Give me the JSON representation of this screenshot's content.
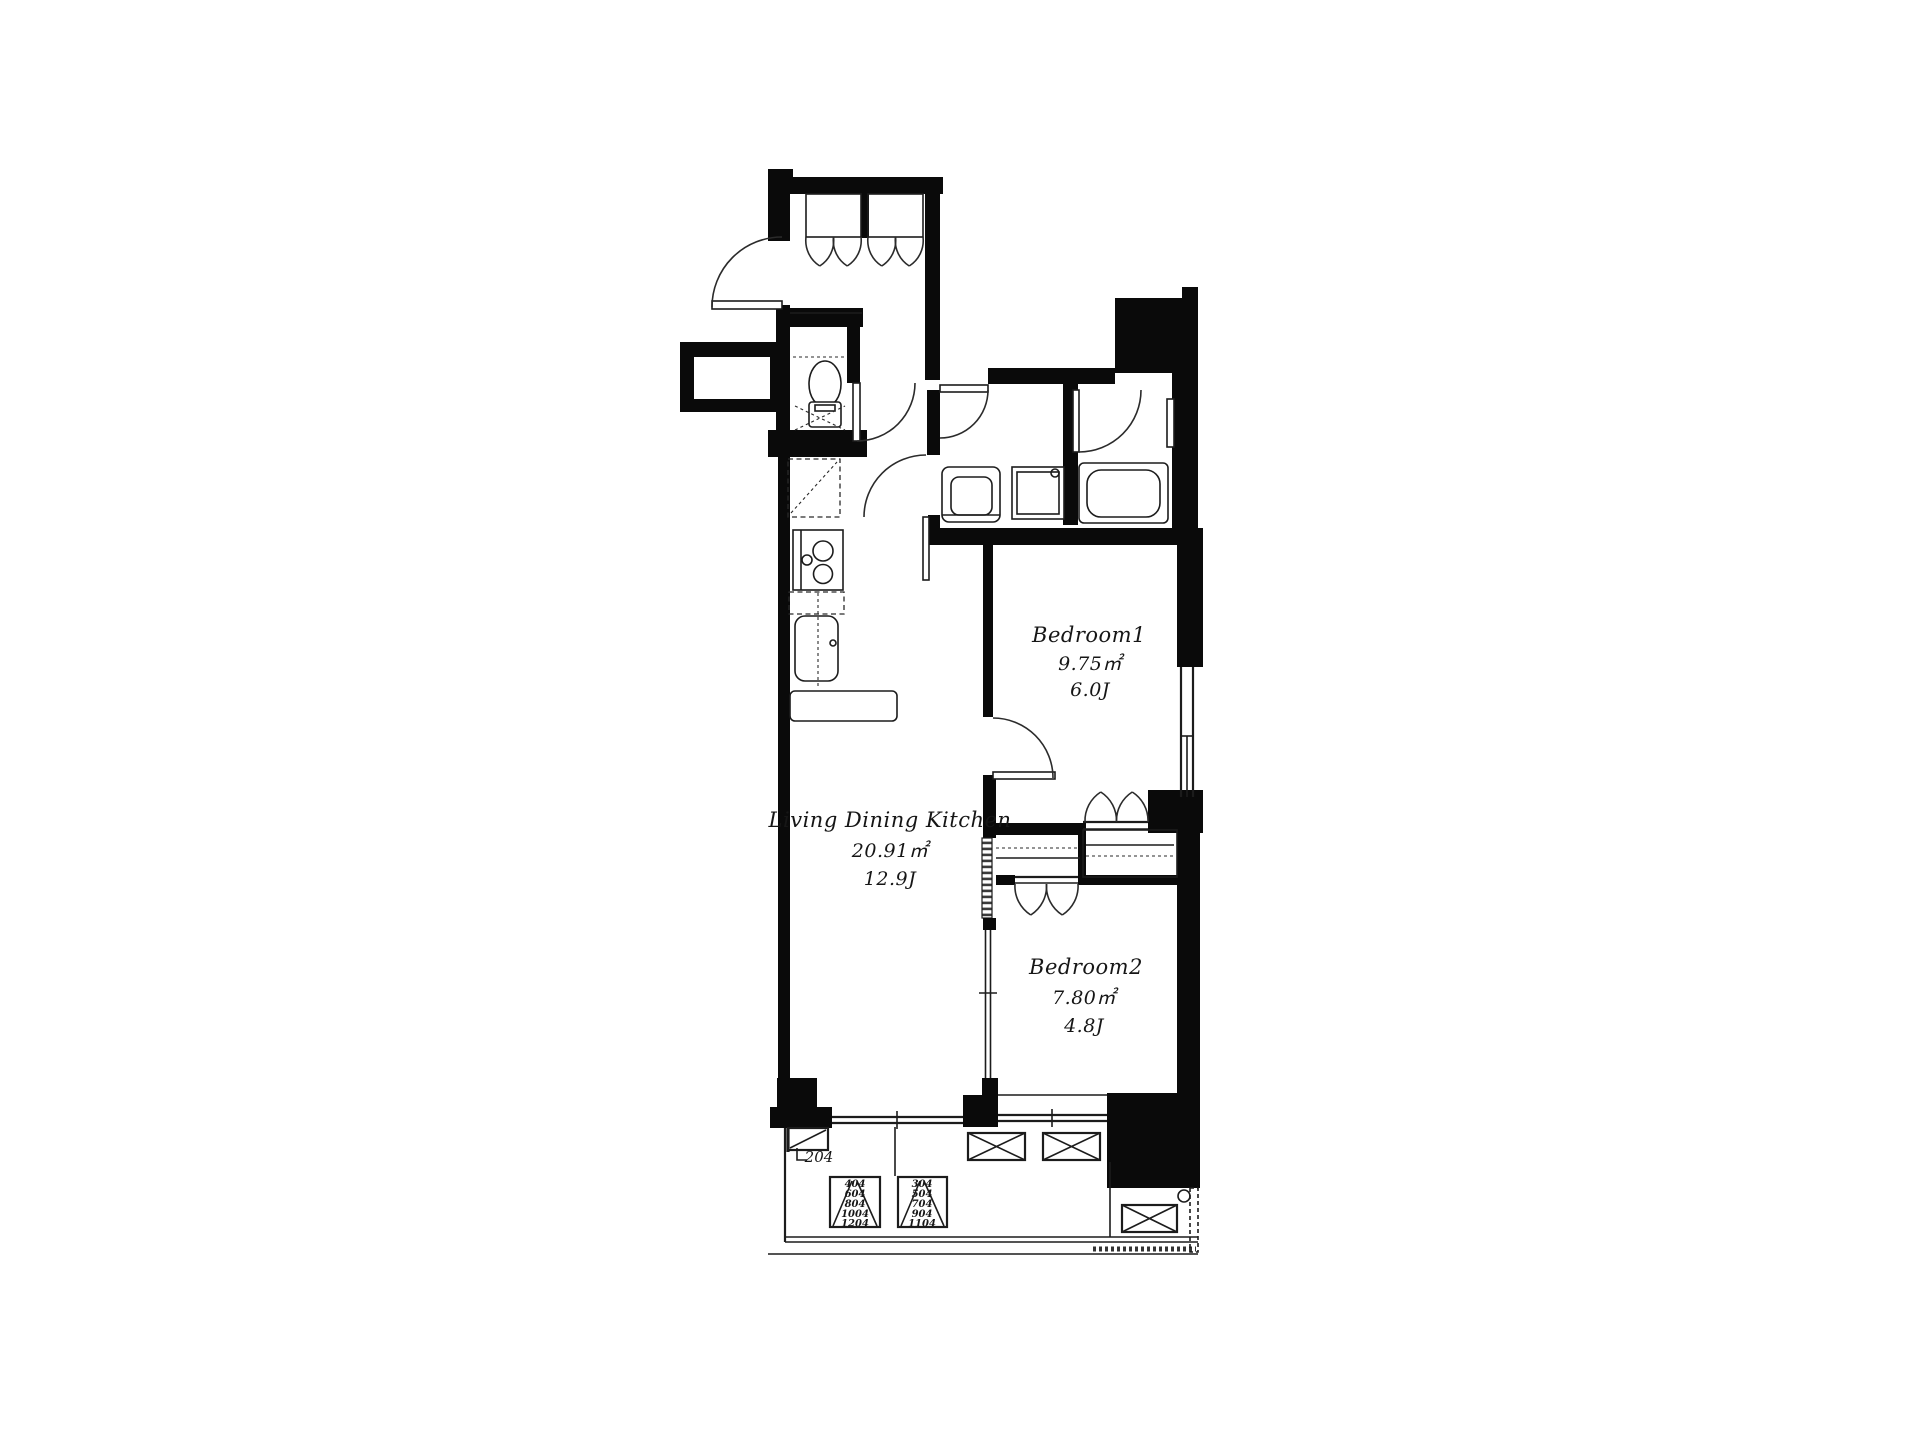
{
  "plan": {
    "rooms": {
      "ldk": {
        "name": "Living Dining Kitchen",
        "area_sqm": "20.91㎡",
        "area_tatami": "12.9J"
      },
      "bedroom1": {
        "name": "Bedroom1",
        "area_sqm": "9.75㎡",
        "area_tatami": "6.0J"
      },
      "bedroom2": {
        "name": "Bedroom2",
        "area_sqm": "7.80㎡",
        "area_tatami": "4.8J"
      }
    },
    "balcony": {
      "unit_label": "204",
      "hatch_stacks": [
        {
          "floors": [
            "404",
            "604",
            "804",
            "1004",
            "1204"
          ]
        },
        {
          "floors": [
            "304",
            "504",
            "704",
            "904",
            "1104"
          ]
        }
      ]
    },
    "colors": {
      "wall": "#0a0a0a",
      "line": "#1c1c1c",
      "background": "#ffffff"
    }
  }
}
